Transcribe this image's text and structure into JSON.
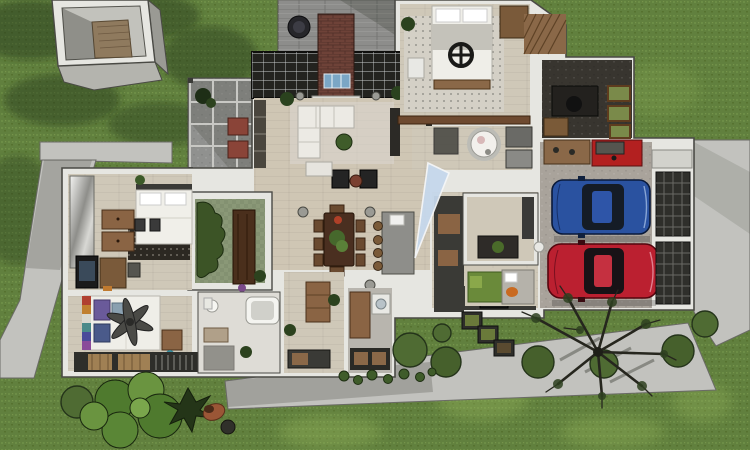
{
  "scene": {
    "type": "3d-floorplan-render",
    "view": "top-down-dollhouse-cutaway",
    "time_of_day": "daylight"
  },
  "colors": {
    "grass": "#61803e",
    "grass_light": "#9cbb5e",
    "grass_shadow": "#1c2e12",
    "path": "#c2c2be",
    "path_shadow": "#8f918d",
    "wall": "#e6e6e1",
    "wall_outline": "#4a4a45",
    "wood_floor": "#cfc6b4",
    "stone": "#8d8d8b",
    "brick": "#6e4238",
    "glass": "#23231f",
    "frame_light": "#c9ccce",
    "skylight_blue": "#c6d8ec",
    "courtyard": "#8a9877",
    "hedge": "#3c5426",
    "bush": "#4f6b33",
    "bush_dark": "#243518",
    "tree_branch": "#26261e",
    "garage_floor": "#a9a39b",
    "tool_red": "#b32020",
    "charcoal": "#3a3a36",
    "wood_furniture": "#8a6444",
    "white_furniture": "#efeee8",
    "rug_dark": "#2c2822",
    "deck_dark": "#2e2e2a",
    "terracotta": "#9a5636"
  },
  "house": {
    "rooms": [
      {
        "name": "stone-patio"
      },
      {
        "name": "pergola"
      },
      {
        "name": "living-room"
      },
      {
        "name": "dining-area"
      },
      {
        "name": "kitchen"
      },
      {
        "name": "courtyard-atrium"
      },
      {
        "name": "bedroom-northwest"
      },
      {
        "name": "bedroom-southwest"
      },
      {
        "name": "bathroom-west"
      },
      {
        "name": "bedroom-north"
      },
      {
        "name": "bathroom-round-tub"
      },
      {
        "name": "home-office"
      },
      {
        "name": "study-nook"
      },
      {
        "name": "entry-hall"
      },
      {
        "name": "mudroom-laundry"
      },
      {
        "name": "kids-room"
      },
      {
        "name": "garage"
      }
    ]
  },
  "vehicles": [
    {
      "name": "blue-sedan",
      "color": "#2a52a0"
    },
    {
      "name": "red-sedan",
      "color": "#bb2030"
    }
  ],
  "landscape": {
    "structures": [
      "garden-shed-cube",
      "pergola-frame"
    ],
    "paths": [
      "left-walkway",
      "north-walkway",
      "south-walkway",
      "driveway"
    ],
    "plants": [
      "round-bushes",
      "leafy-shrub-cluster",
      "bare-tree",
      "conifer",
      "hedge",
      "fallen-flower-pot",
      "planter-boxes"
    ]
  }
}
